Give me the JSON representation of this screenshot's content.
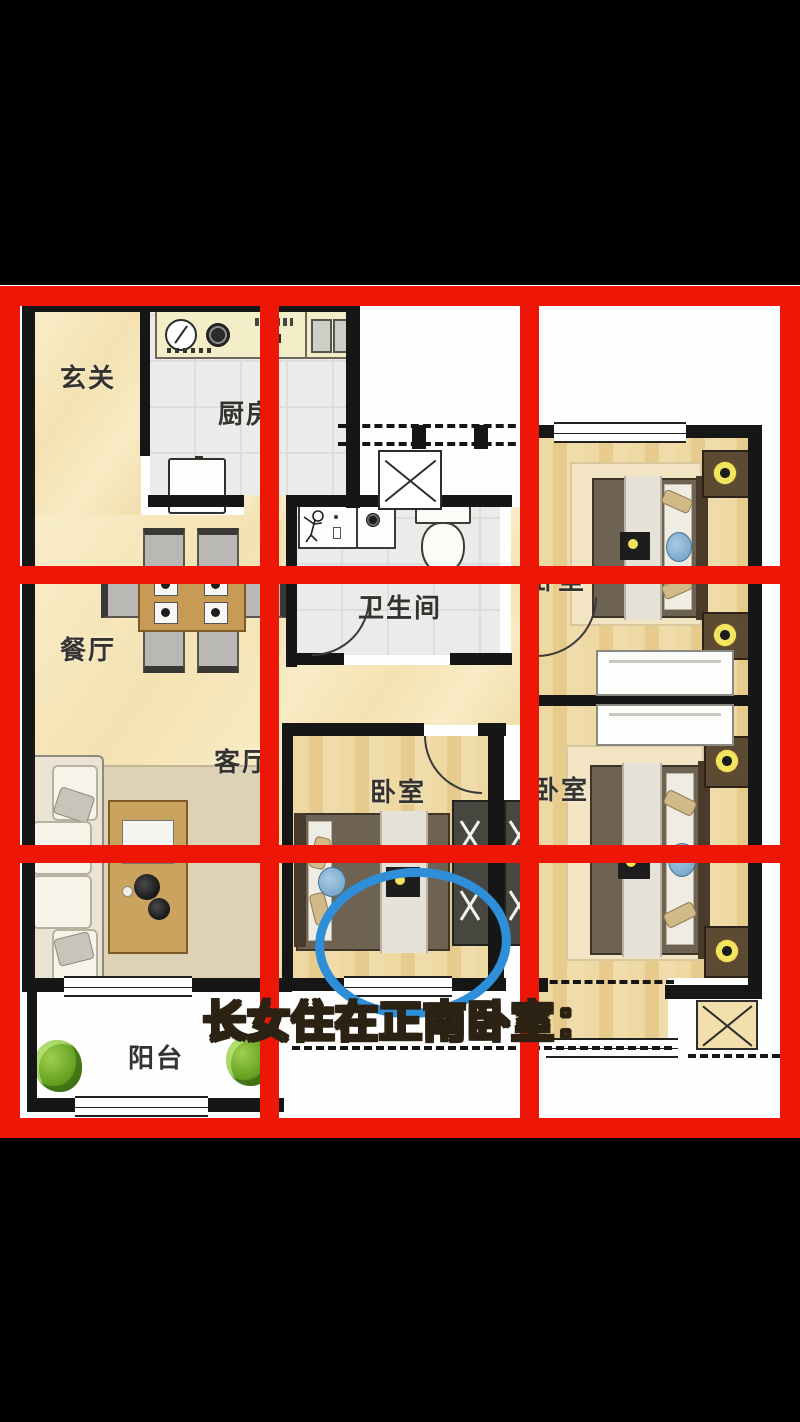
{
  "scene": {
    "type": "apartment-floorplan-annotated",
    "description": "3-bedroom apartment floor plan overlaid with a red 3x3 nine-palace grid, a blue ellipse circling the bed of the due-south bedroom, and a colorful caption"
  },
  "rooms": {
    "entry": {
      "label": "玄关"
    },
    "kitchen": {
      "label": "厨房"
    },
    "dining": {
      "label": "餐厅"
    },
    "living": {
      "label": "客厅"
    },
    "bathroom": {
      "label": "卫生间"
    },
    "bedroom_ne": {
      "label": "卧室"
    },
    "bedroom_s": {
      "label": "卧室"
    },
    "bedroom_se": {
      "label": "卧室"
    },
    "balcony": {
      "label": "阳台"
    }
  },
  "caption": {
    "text": "长女住在正南卧室：",
    "outline_color": "#2c2214",
    "chars": [
      {
        "ch": "长",
        "color": "#38a4e8"
      },
      {
        "ch": "女",
        "color": "#8fd8c2"
      },
      {
        "ch": "住",
        "color": "#f2ea5e"
      },
      {
        "ch": "在",
        "color": "#f0a878"
      },
      {
        "ch": "正",
        "color": "#f5a8bc"
      },
      {
        "ch": "南",
        "color": "#4496e2"
      },
      {
        "ch": "卧",
        "color": "#5ac6da"
      },
      {
        "ch": "室",
        "color": "#f0d84e"
      },
      {
        "ch": "：",
        "color": "#4a3a28"
      }
    ]
  },
  "overlay": {
    "grid_color": "#ee1606",
    "grid_rows": 3,
    "grid_cols": 3,
    "highlight_ellipse_color": "#2e8fd8"
  }
}
